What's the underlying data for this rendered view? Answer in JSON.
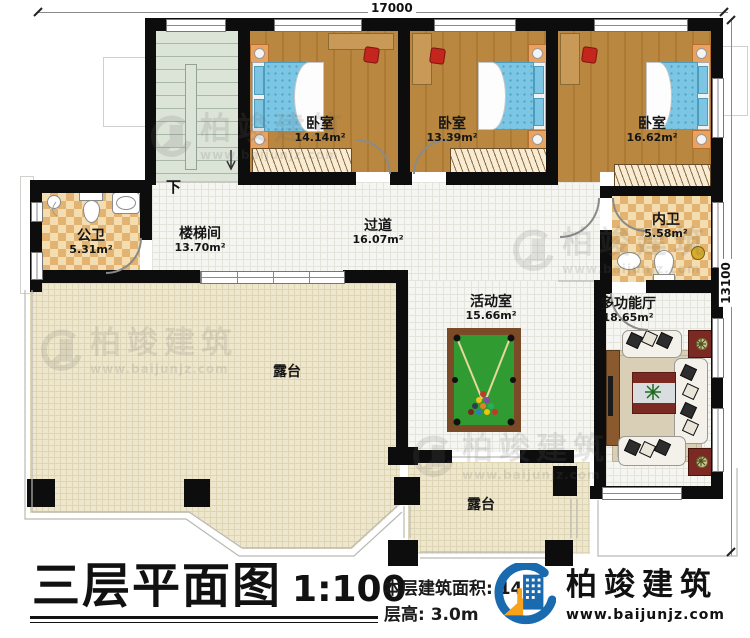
{
  "dimensions": {
    "top": "17000",
    "right": "13100"
  },
  "rooms": [
    {
      "id": "bedroom-1",
      "name": "卧室",
      "area": "14.14m²"
    },
    {
      "id": "bedroom-2",
      "name": "卧室",
      "area": "13.39m²"
    },
    {
      "id": "bedroom-3",
      "name": "卧室",
      "area": "16.62m²"
    },
    {
      "id": "public-bath",
      "name": "公卫",
      "area": "5.31m²"
    },
    {
      "id": "stairwell",
      "name": "楼梯间",
      "area": "13.70m²"
    },
    {
      "id": "hallway",
      "name": "过道",
      "area": "16.07m²"
    },
    {
      "id": "inner-bath",
      "name": "内卫",
      "area": "5.58m²"
    },
    {
      "id": "activity-room",
      "name": "活动室",
      "area": "15.66m²"
    },
    {
      "id": "multi-hall",
      "name": "多功能厅",
      "area": "18.65m²"
    },
    {
      "id": "terrace-left",
      "name": "露台"
    },
    {
      "id": "terrace-bottom",
      "name": "露台"
    }
  ],
  "stair": {
    "down_label": "下"
  },
  "titleblock": {
    "title": "三层平面图",
    "scale": "1:100",
    "area_label": "本层建筑面积: 140",
    "floor_height": "层高: 3.0m"
  },
  "brand": {
    "name": "柏竣建筑",
    "website": "www.baijunjz.com"
  },
  "watermark": {
    "name": "柏竣建筑",
    "website": "www.baijunjz.com"
  },
  "colors": {
    "wall": "#0d0d0d",
    "wood_floor": "#b9873f",
    "tile_floor": "#e2b371",
    "terrace_floor": "#efe7cd",
    "corridor_floor": "#f5f5f1",
    "stair_floor": "#dce3d7",
    "billiard_green": "#2f9b30",
    "billiard_frame": "#7b4a26",
    "bed_blue": "#7cc6e4",
    "accent_red": "#c4261d",
    "logo_blue": "#1a6ab0",
    "logo_orange": "#f6a21d"
  }
}
